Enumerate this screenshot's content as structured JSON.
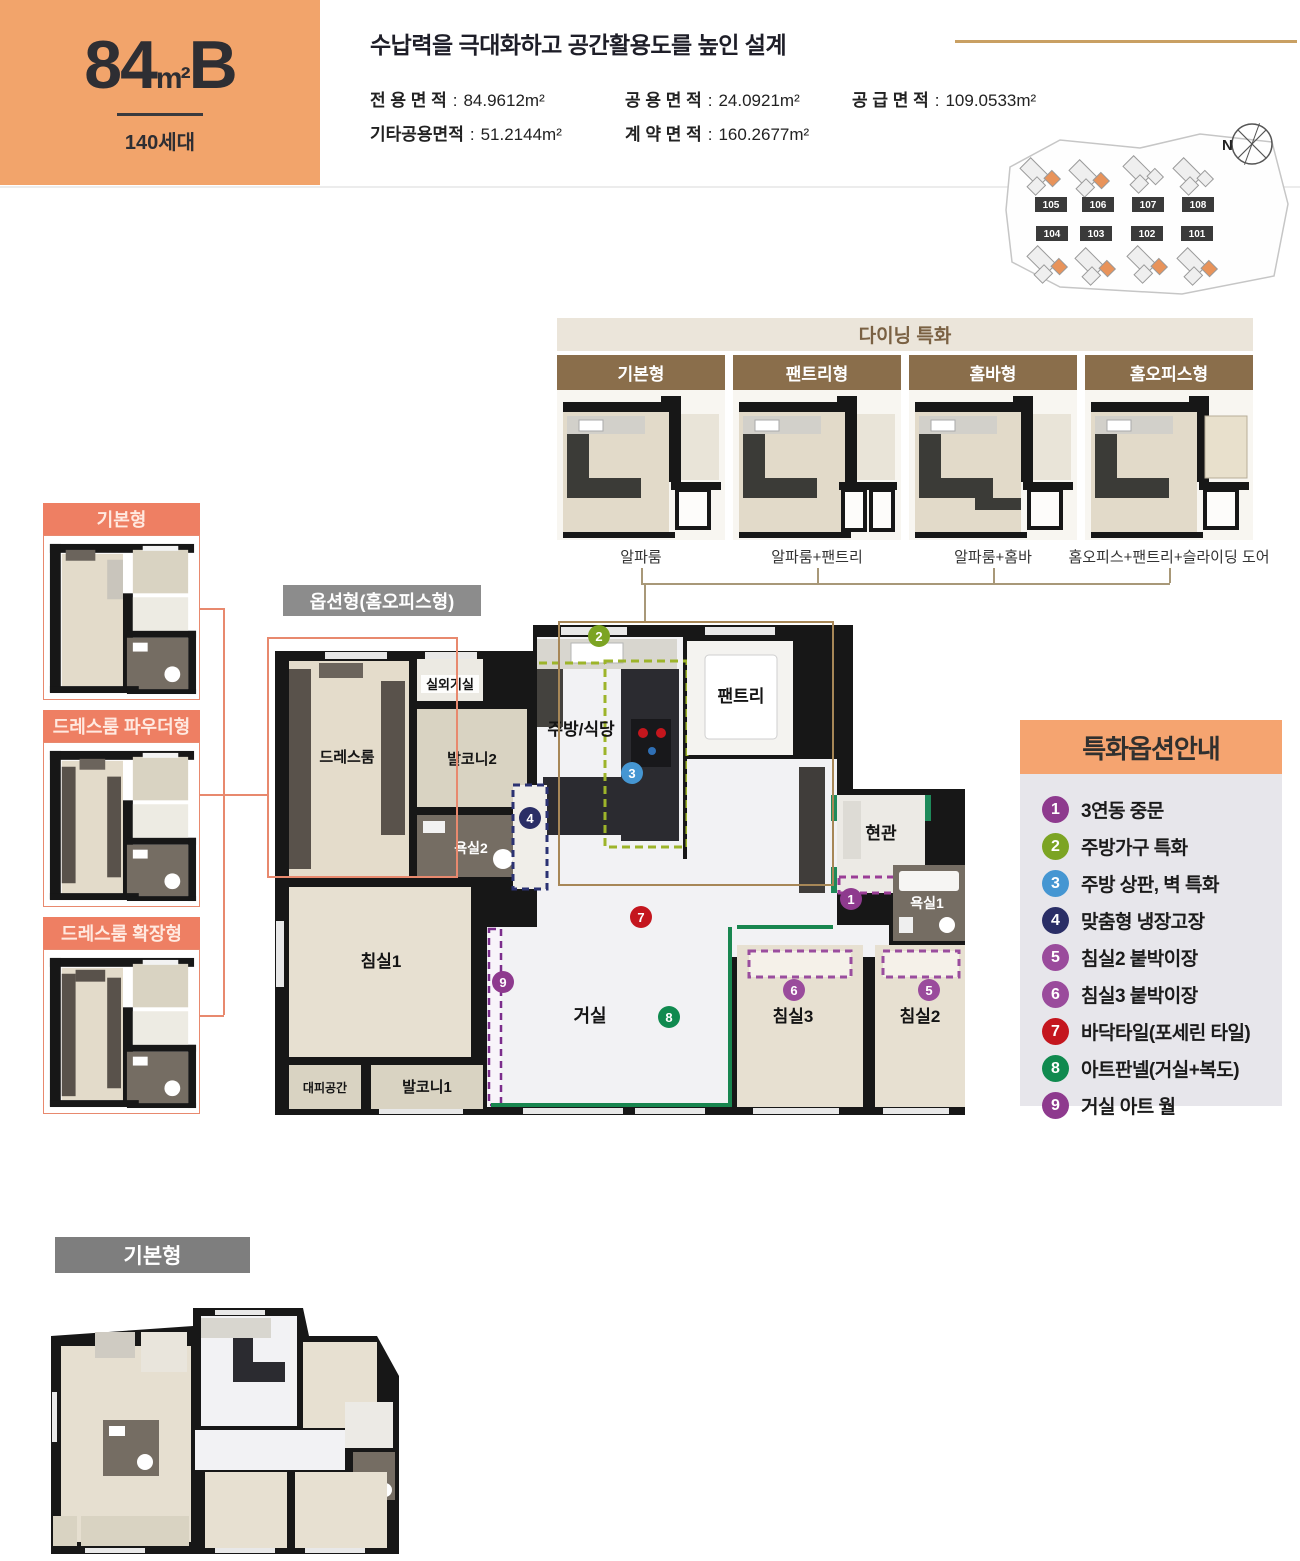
{
  "header": {
    "type_num": "84",
    "type_unit": "m²",
    "type_suffix": "B",
    "units_label": "140세대",
    "title": "수납력을 극대화하고 공간활용도를 높인 설계",
    "specs": [
      {
        "label": "전 용 면 적",
        "value": "84.9612m²"
      },
      {
        "label": "공 용 면 적",
        "value": "24.0921m²"
      },
      {
        "label": "공 급 면 적",
        "value": "109.0533m²"
      },
      {
        "label": "기타공용면적",
        "value": "51.2144m²"
      },
      {
        "label": "계 약 면 적",
        "value": "160.2677m²"
      }
    ]
  },
  "site_plan": {
    "compass": "N",
    "buildings": [
      "105",
      "106",
      "107",
      "108",
      "104",
      "103",
      "102",
      "101"
    ]
  },
  "dining": {
    "title": "다이닝 특화",
    "options": [
      {
        "name": "기본형",
        "caption": "알파룸"
      },
      {
        "name": "팬트리형",
        "caption": "알파룸+팬트리"
      },
      {
        "name": "홈바형",
        "caption": "알파룸+홈바"
      },
      {
        "name": "홈오피스형",
        "caption": "홈오피스+팬트리+슬라이딩 도어"
      }
    ]
  },
  "dressroom_options": [
    {
      "name": "기본형"
    },
    {
      "name": "드레스룸 파우더형"
    },
    {
      "name": "드레스룸 확장형"
    }
  ],
  "main_plan": {
    "label": "옵션형(홈오피스형)",
    "rooms": [
      "실외기실",
      "발코니2",
      "드레스룸",
      "욕실2",
      "주방/식당",
      "팬트리",
      "현관",
      "욕실1",
      "침실1",
      "거실",
      "침실3",
      "침실2",
      "대피공간",
      "발코니1"
    ]
  },
  "legend": {
    "title": "특화옵션안내",
    "items": [
      {
        "num": "1",
        "label": "3연동 중문",
        "color": "#8E3A8E"
      },
      {
        "num": "2",
        "label": "주방가구 특화",
        "color": "#7CA423"
      },
      {
        "num": "3",
        "label": "주방 상판, 벽 특화",
        "color": "#4596D2"
      },
      {
        "num": "4",
        "label": "맞춤형 냉장고장",
        "color": "#2A2E66"
      },
      {
        "num": "5",
        "label": "침실2 붙박이장",
        "color": "#9A4B9C"
      },
      {
        "num": "6",
        "label": "침실3 붙박이장",
        "color": "#9A4B9C"
      },
      {
        "num": "7",
        "label": "바닥타일(포세린 타일)",
        "color": "#C4161E"
      },
      {
        "num": "8",
        "label": "아트판넬(거실+복도)",
        "color": "#108A4F"
      },
      {
        "num": "9",
        "label": "거실 아트 월",
        "color": "#8E3A8E"
      }
    ]
  },
  "base_plan": {
    "label": "기본형"
  },
  "colors": {
    "accent_orange": "#F2A46B",
    "salmon": "#EE7F63",
    "card_brown": "#8A6E4B",
    "tan_line": "#C9A063",
    "legend_bg": "#E7E6EB",
    "legend_header": "#F5A470",
    "gray_bar": "#7E7E7E",
    "wall_black": "#171717",
    "accent_green": "#18864F",
    "accent_olive": "#9DB42A"
  }
}
